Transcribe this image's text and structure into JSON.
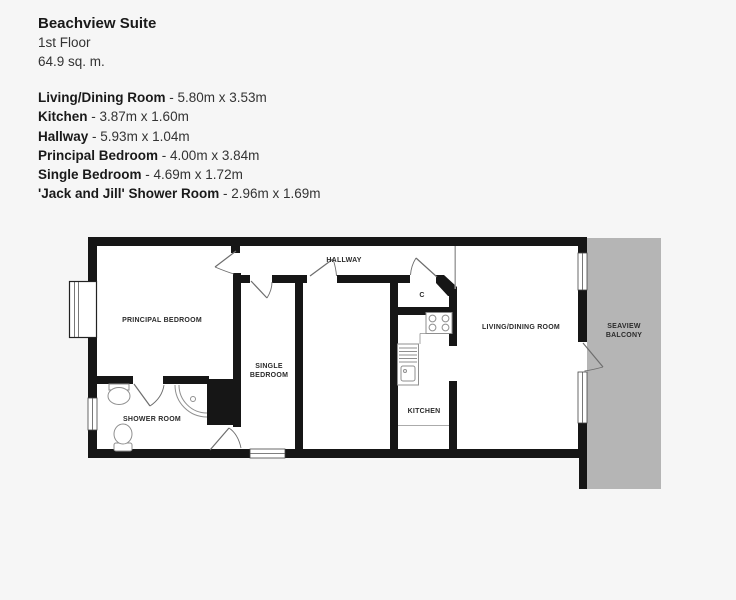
{
  "header": {
    "title": "Beachview Suite",
    "floor": "1st Floor",
    "area": "64.9 sq. m."
  },
  "rooms": [
    {
      "name": "Living/Dining Room",
      "dims": "- 5.80m x 3.53m"
    },
    {
      "name": "Kitchen",
      "dims": "- 3.87m x 1.60m"
    },
    {
      "name": "Hallway",
      "dims": "- 5.93m x 1.04m"
    },
    {
      "name": "Principal Bedroom",
      "dims": "- 4.00m x 3.84m"
    },
    {
      "name": "Single Bedroom",
      "dims": "- 4.69m x 1.72m"
    },
    {
      "name": "'Jack and Jill' Shower Room",
      "dims": "- 2.96m x 1.69m"
    }
  ],
  "floorplan": {
    "labels": {
      "principal_bedroom": "PRINCIPAL BEDROOM",
      "single_bedroom_line1": "SINGLE",
      "single_bedroom_line2": "BEDROOM",
      "shower_room": "SHOWER ROOM",
      "hallway": "HALLWAY",
      "cupboard": "C",
      "kitchen": "KITCHEN",
      "living_dining": "LIVING/DINING ROOM",
      "balcony_line1": "SEAVIEW",
      "balcony_line2": "BALCONY"
    },
    "colors": {
      "wall": "#161616",
      "balcony": "#b5b5b5",
      "background": "#f6f6f6",
      "interior": "#ffffff"
    }
  }
}
